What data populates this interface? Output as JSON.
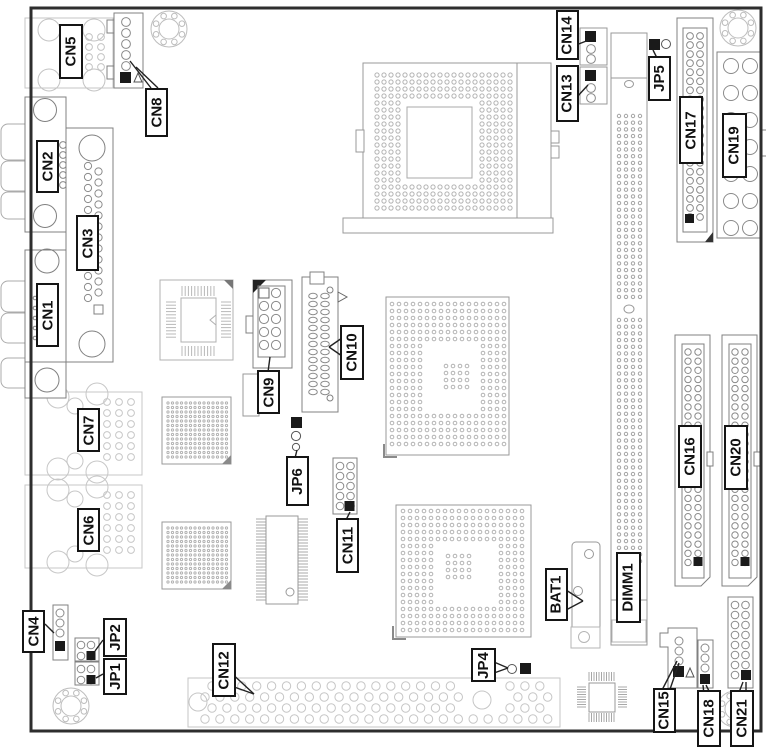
{
  "diagram": {
    "kind": "board-connector-location-diagram"
  },
  "labels": {
    "cn1": "CN1",
    "cn2": "CN2",
    "cn3": "CN3",
    "cn4": "CN4",
    "cn5": "CN5",
    "cn6": "CN6",
    "cn7": "CN7",
    "cn8": "CN8",
    "cn9": "CN9",
    "cn10": "CN10",
    "cn11": "CN11",
    "cn12": "CN12",
    "cn13": "CN13",
    "cn14": "CN14",
    "cn15": "CN15",
    "cn16": "CN16",
    "cn17": "CN17",
    "cn18": "CN18",
    "cn19": "CN19",
    "cn20": "CN20",
    "cn21": "CN21",
    "jp1": "JP1",
    "jp2": "JP2",
    "jp4": "JP4",
    "jp5": "JP5",
    "jp6": "JP6",
    "bat1": "BAT1",
    "dimm1": "DIMM1"
  },
  "colors": {
    "board_outline": "#2e2e2e",
    "component_stroke": "#808080",
    "ghost_stroke": "#c4c4c4",
    "fine_pin_stroke": "#b3b3b3",
    "label_border": "#151515",
    "pin1_fill": "#1a1a1a",
    "background": "#ffffff"
  }
}
